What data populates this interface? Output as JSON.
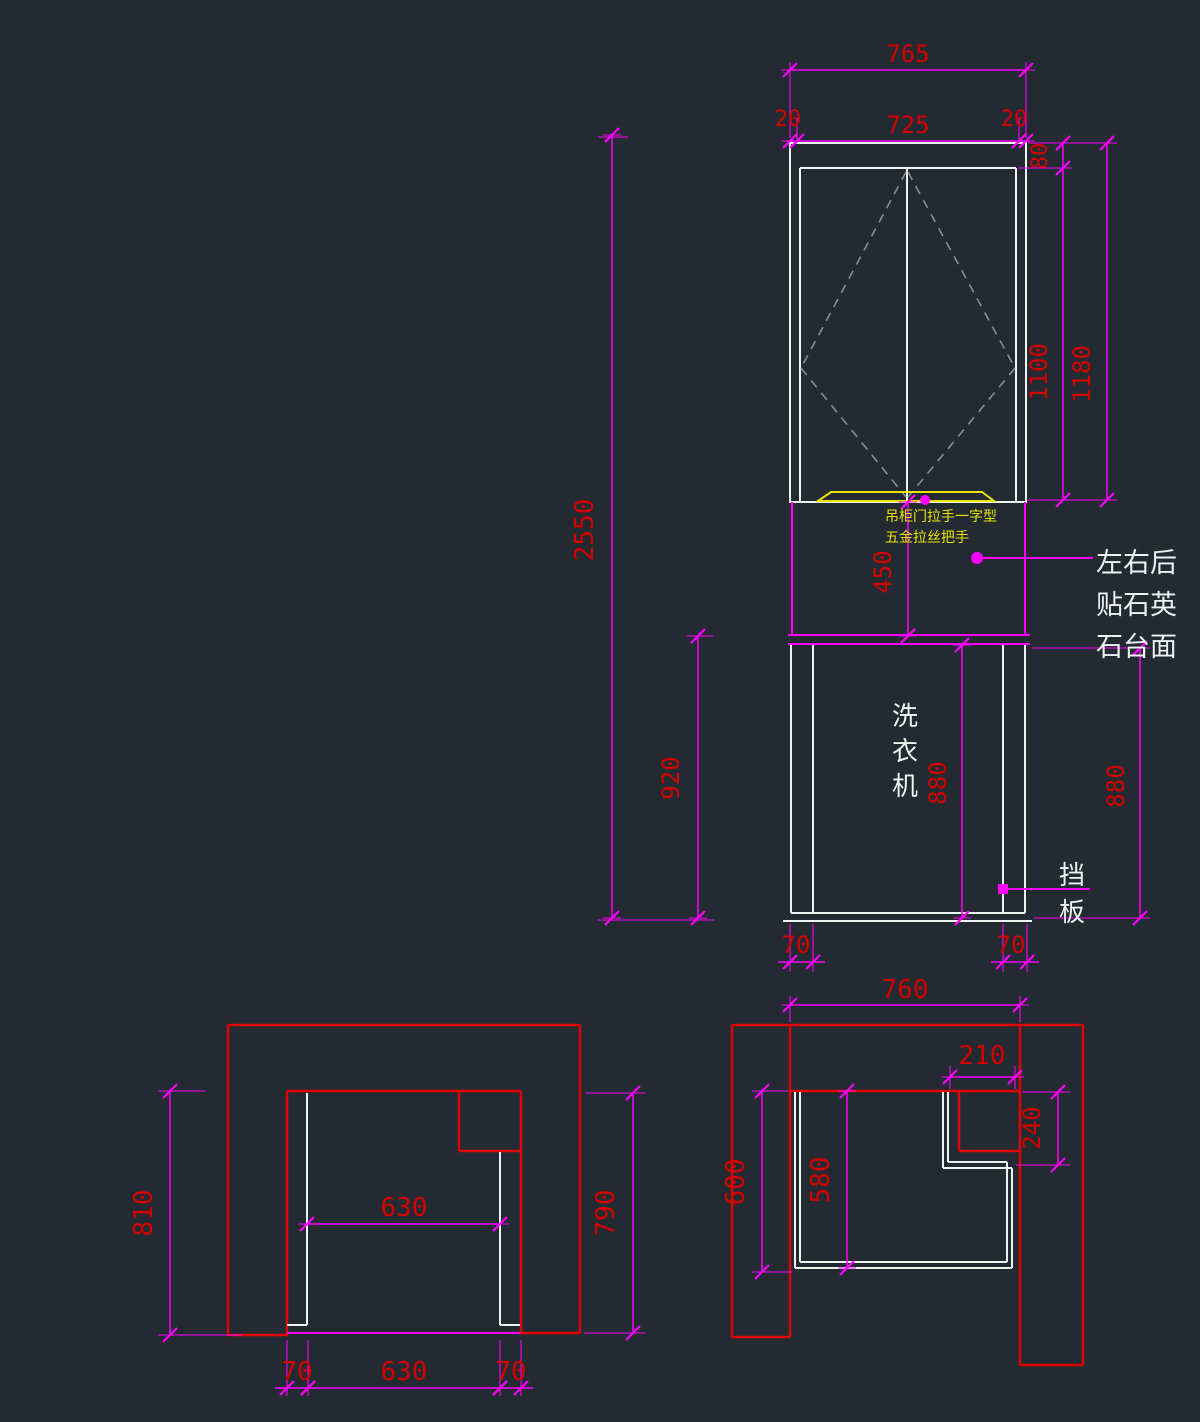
{
  "colors": {
    "background": "#242a32",
    "wall_red": "#e00505",
    "dim_magenta": "#ff00ff",
    "dim_text_red": "#d40000",
    "object_white": "#eef2f2",
    "handle_yellow": "#e8e400",
    "door_swing_gray": "#8c8c8c"
  },
  "elevation": {
    "dims": {
      "overall_width": "765",
      "side_left": "20",
      "inner_width": "725",
      "side_right": "20",
      "top_rail": "80",
      "door_height": "1100",
      "upper_height": "1180",
      "total_height": "2550",
      "splash_height": "450",
      "base_height": "920",
      "niche_height": "880",
      "right_height": "880",
      "foot_left": "70",
      "foot_right": "70"
    },
    "notes": {
      "handle_line1": "吊柜门拉手一字型",
      "handle_line2": "五金拉丝把手",
      "counter": [
        "左右后",
        "贴石英",
        "石台面"
      ],
      "machine": [
        "洗",
        "衣",
        "机"
      ],
      "baffle": [
        "挡",
        "板"
      ]
    }
  },
  "plan_left": {
    "dims": {
      "height_left": "810",
      "inner_width": "630",
      "height_right": "790",
      "foot_left": "70",
      "bottom_width": "630",
      "foot_right": "70"
    }
  },
  "plan_right": {
    "dims": {
      "inner_width": "760",
      "notch_width": "210",
      "notch_depth": "240",
      "depth_left": "600",
      "depth_inner": "580"
    }
  }
}
